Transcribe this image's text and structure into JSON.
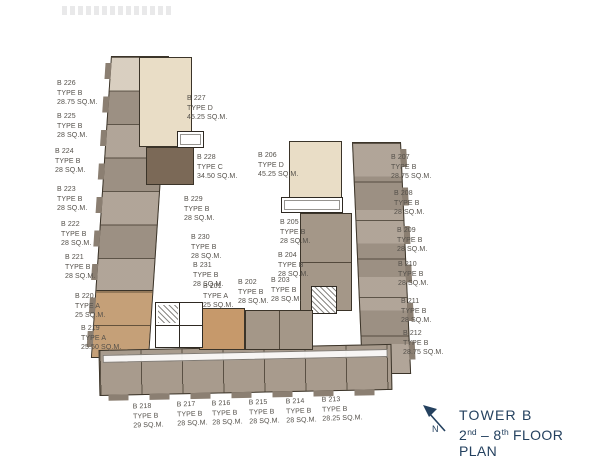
{
  "legend": {
    "tower": "TOWER B",
    "floor_from": "2",
    "floor_from_sup": "nd",
    "dash": " – ",
    "floor_to": "8",
    "floor_to_sup": "th",
    "floor_word": " FLOOR PLAN",
    "north": "N"
  },
  "colors": {
    "brand_navy": "#24415f",
    "type_a_tan": "#c5a078",
    "type_b_taupe": "#a89b8d",
    "type_c_brown": "#7b6957",
    "type_d_cream": "#e9ddc6",
    "outline_ink": "#3b3429",
    "label_text": "#54504a"
  },
  "units": [
    {
      "id": "B 226",
      "type": "TYPE B",
      "area": "28.75 SQ.M."
    },
    {
      "id": "B 225",
      "type": "TYPE B",
      "area": "28 SQ.M."
    },
    {
      "id": "B 224",
      "type": "TYPE B",
      "area": "28 SQ.M."
    },
    {
      "id": "B 223",
      "type": "TYPE B",
      "area": "28 SQ.M."
    },
    {
      "id": "B 222",
      "type": "TYPE B",
      "area": "28 SQ.M."
    },
    {
      "id": "B 221",
      "type": "TYPE B",
      "area": "28 SQ.M."
    },
    {
      "id": "B 220",
      "type": "TYPE A",
      "area": "25 SQ.M."
    },
    {
      "id": "B 219",
      "type": "TYPE A",
      "area": "25.50 SQ.M."
    },
    {
      "id": "B 227",
      "type": "TYPE D",
      "area": "45.25 SQ.M."
    },
    {
      "id": "B 228",
      "type": "TYPE C",
      "area": "34.50 SQ.M."
    },
    {
      "id": "B 229",
      "type": "TYPE B",
      "area": "28 SQ.M."
    },
    {
      "id": "B 230",
      "type": "TYPE B",
      "area": "28 SQ.M."
    },
    {
      "id": "B 231",
      "type": "TYPE B",
      "area": "28 SQ.M."
    },
    {
      "id": "B 201",
      "type": "TYPE A",
      "area": "25 SQ.M."
    },
    {
      "id": "B 202",
      "type": "TYPE B",
      "area": "28 SQ.M."
    },
    {
      "id": "B 203",
      "type": "TYPE B",
      "area": "28 SQ.M."
    },
    {
      "id": "B 204",
      "type": "TYPE B",
      "area": "28 SQ.M."
    },
    {
      "id": "B 205",
      "type": "TYPE B",
      "area": "28 SQ.M."
    },
    {
      "id": "B 206",
      "type": "TYPE D",
      "area": "45.25 SQ.M."
    },
    {
      "id": "B 207",
      "type": "TYPE B",
      "area": "28.75 SQ.M."
    },
    {
      "id": "B 208",
      "type": "TYPE B",
      "area": "28 SQ.M."
    },
    {
      "id": "B 209",
      "type": "TYPE B",
      "area": "28 SQ.M."
    },
    {
      "id": "B 210",
      "type": "TYPE B",
      "area": "28 SQ.M."
    },
    {
      "id": "B 211",
      "type": "TYPE B",
      "area": "28 SQ.M."
    },
    {
      "id": "B 212",
      "type": "TYPE B",
      "area": "28.75 SQ.M."
    },
    {
      "id": "B 218",
      "type": "TYPE B",
      "area": "29 SQ.M."
    },
    {
      "id": "B 217",
      "type": "TYPE B",
      "area": "28 SQ.M."
    },
    {
      "id": "B 216",
      "type": "TYPE B",
      "area": "28 SQ.M."
    },
    {
      "id": "B 215",
      "type": "TYPE B",
      "area": "28 SQ.M."
    },
    {
      "id": "B 214",
      "type": "TYPE B",
      "area": "28 SQ.M."
    },
    {
      "id": "B 213",
      "type": "TYPE B",
      "area": "28.25 SQ.M."
    }
  ]
}
